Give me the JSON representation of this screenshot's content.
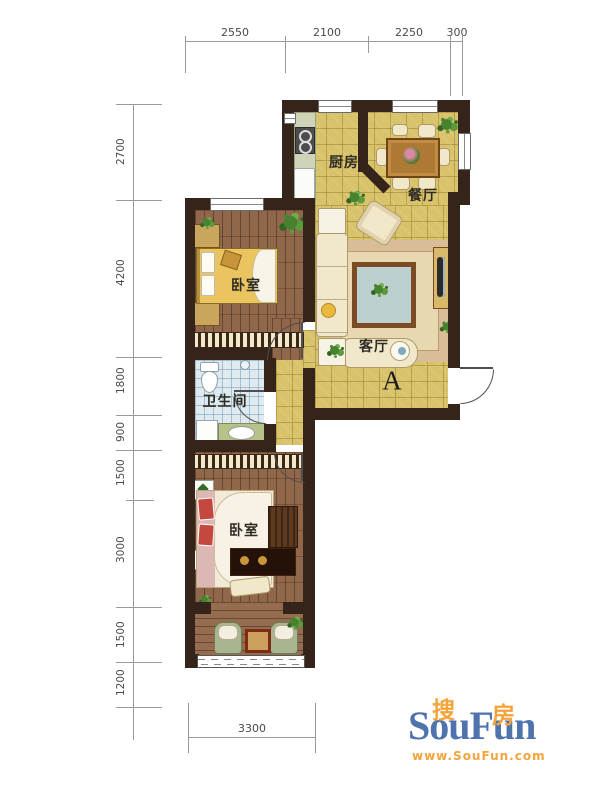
{
  "dimensions": {
    "top": [
      "2550",
      "2100",
      "2250",
      "300"
    ],
    "left": [
      "2700",
      "4200",
      "1800",
      "900",
      "1500",
      "3000",
      "1500",
      "1200"
    ],
    "bottom": [
      "3300"
    ]
  },
  "rooms": {
    "kitchen": "厨房",
    "dining": "餐厅",
    "living": "客厅",
    "bedroom_top": "卧室",
    "bathroom": "卫生间",
    "bedroom_bottom": "卧室",
    "entry_zone": "A"
  },
  "logo": {
    "brand": "SouFun",
    "cn_left": "搜",
    "cn_right": "房",
    "url": "www.SouFun.com"
  },
  "colors": {
    "wall": "#35241a",
    "tile_floor": "#d8c36b",
    "wood_floor": "#91674c",
    "bath_floor": "#dfeaf0",
    "logo_blue": "#4f73ad",
    "logo_orange": "#f4a43b"
  }
}
